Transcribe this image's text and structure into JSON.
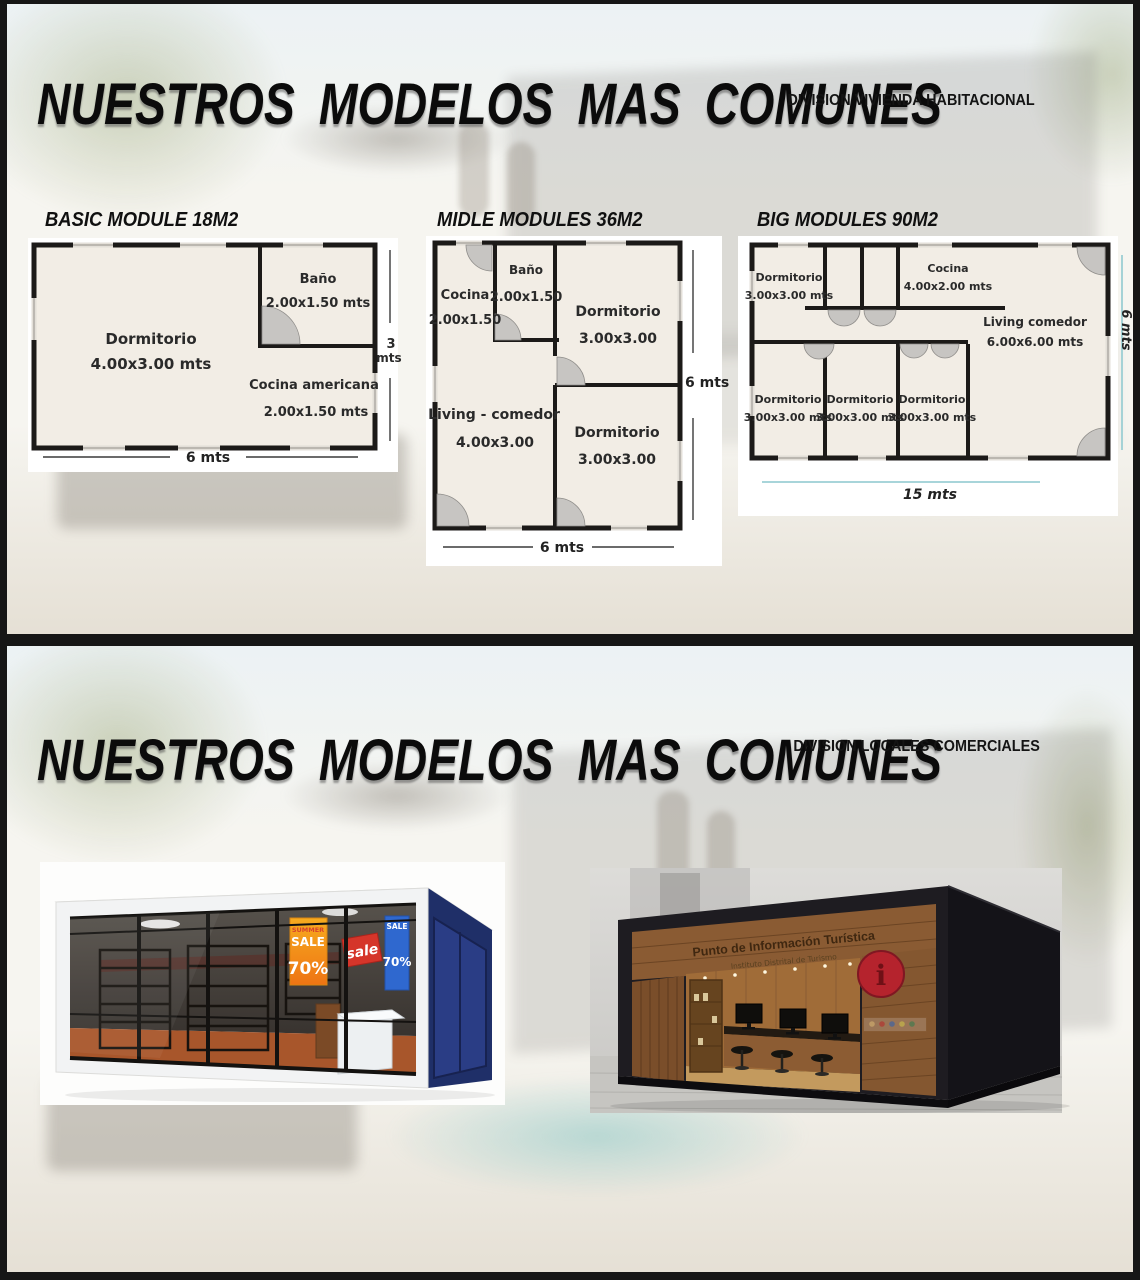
{
  "s1": {
    "title": "NUESTROS MODELOS MAS COMUNES",
    "subtitle": "DIVISION VIVIENDA HABITACIONAL",
    "plan1": {
      "heading": "BASIC MODULE 18M2",
      "rooms": [
        {
          "name": "Dormitorio",
          "dims": "4.00x3.00 mts"
        },
        {
          "name": "Baño",
          "dims": "2.00x1.50 mts"
        },
        {
          "name": "Cocina americana",
          "dims": "2.00x1.50 mts"
        }
      ],
      "width_dim": "6 mts",
      "height_value": "3",
      "height_unit": "mts"
    },
    "plan2": {
      "heading": "MIDLE MODULES 36M2",
      "rooms": [
        {
          "name": "Cocina",
          "dims": "2.00x1.50"
        },
        {
          "name": "Baño",
          "dims": "2.00x1.50"
        },
        {
          "name": "Dormitorio",
          "dims": "3.00x3.00"
        },
        {
          "name": "Living - comedor",
          "dims": "4.00x3.00"
        },
        {
          "name": "Dormitorio",
          "dims": "3.00x3.00"
        }
      ],
      "width_dim": "6 mts",
      "height_dim": "6 mts"
    },
    "plan3": {
      "heading": "BIG MODULES 90M2",
      "rooms": [
        {
          "name": "Dormitorio",
          "dims": "3.00x3.00 mts"
        },
        {
          "name": "Cocina",
          "dims": "4.00x2.00 mts"
        },
        {
          "name": "Living comedor",
          "dims": "6.00x6.00 mts"
        },
        {
          "name": "Dormitorio",
          "dims": "3.00x3.00 mts"
        },
        {
          "name": "Dormitorio",
          "dims": "3.00x3.00 mts"
        },
        {
          "name": "Dormitorio",
          "dims": "3.00x3.00 mts"
        }
      ],
      "width_dim": "15 mts",
      "height_dim": "6 mts"
    }
  },
  "s2": {
    "title": "NUESTROS MODELOS MAS COMUNES",
    "subtitle": "DIVISION LOCALES COMERCIALES",
    "shop": {
      "poster_top": "SUMMER",
      "poster_mid": "SALE",
      "poster_pct": "70%",
      "tag": "sale",
      "banner_top": "SALE",
      "banner_pct": "70%"
    },
    "kiosk": {
      "sign_title": "Punto de Información Turística",
      "sign_sub": "Instituto Distrital de Turismo",
      "logo": "i"
    }
  },
  "colors": {
    "page-border": "#161616",
    "slide-bg": "#f6f5f0",
    "plan-fill": "#f2ede5",
    "wall": "#1c1a18",
    "door-arc": "#c7c5c2",
    "dim-line": "#3a3a3a",
    "dim-cyan": "#9ccfd4",
    "shop-blue": "#1f2f68",
    "shop-floor": "#a8562b",
    "poster-orange": "#f6a21c",
    "poster-red": "#d5352a",
    "banner-blue": "#2f68cf",
    "kiosk-dark": "#1e1c21",
    "kiosk-wood": "#8a5b33",
    "logo-red": "#b5232d"
  }
}
